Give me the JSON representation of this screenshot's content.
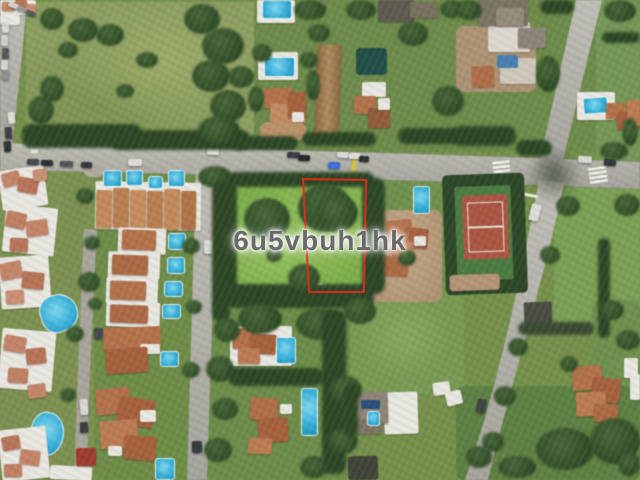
{
  "scene_type": "aerial-photograph of residential area with outlined vacant plot",
  "watermark": {
    "text": "6u5vbuh1hk",
    "color": "#6a6a6a"
  },
  "plot_boundary": {
    "color": "#e5291d",
    "shape": "rectangle"
  },
  "palette": {
    "grass_base": "#74904b",
    "field_olive": "#8c9e62",
    "plot_grass": "#7fae4e",
    "road_gray": "#b2b0aa",
    "tree_dark": "#2d4626",
    "roof_terracotta": "#b1714c",
    "roof_salmon": "#c2856a",
    "pool_azure": "#3db0da",
    "tennis_clay": "#a85643",
    "tennis_surround": "#4c7a44",
    "dirt_tan": "#b29478",
    "white_building": "#e9e7e1"
  }
}
